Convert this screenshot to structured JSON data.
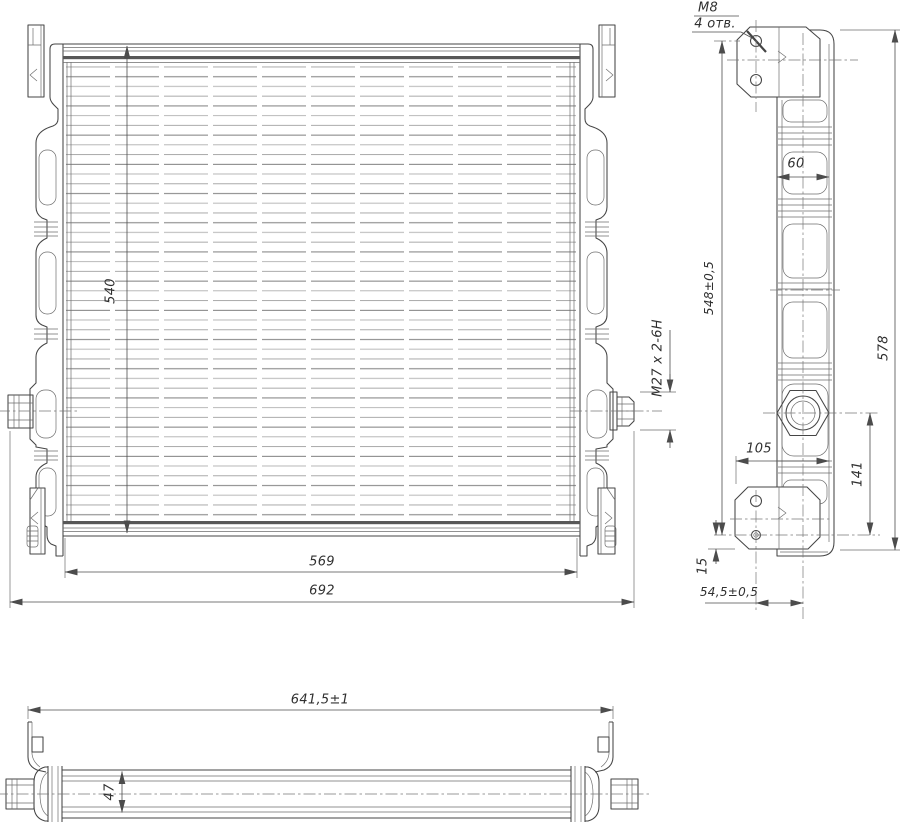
{
  "labels": {
    "core_height": "540",
    "core_width": "569",
    "overall_width": "692",
    "outlet_thread": "M27 x 2-6H",
    "mount_thread": "M8",
    "mount_holes": "4 отв.",
    "tank_width": "60",
    "hole_span": "548±0,5",
    "overall_height": "578",
    "bracket_width": "105",
    "outlet_to_hole": "141",
    "hole_to_edge": "15",
    "hole_offset": "54,5±0,5",
    "bracket_span": "641,5±1",
    "core_depth": "47"
  },
  "colors": {
    "line": "#454545",
    "thin_line": "#6e6e6e",
    "centerline": "#777777",
    "background": "#ffffff"
  }
}
